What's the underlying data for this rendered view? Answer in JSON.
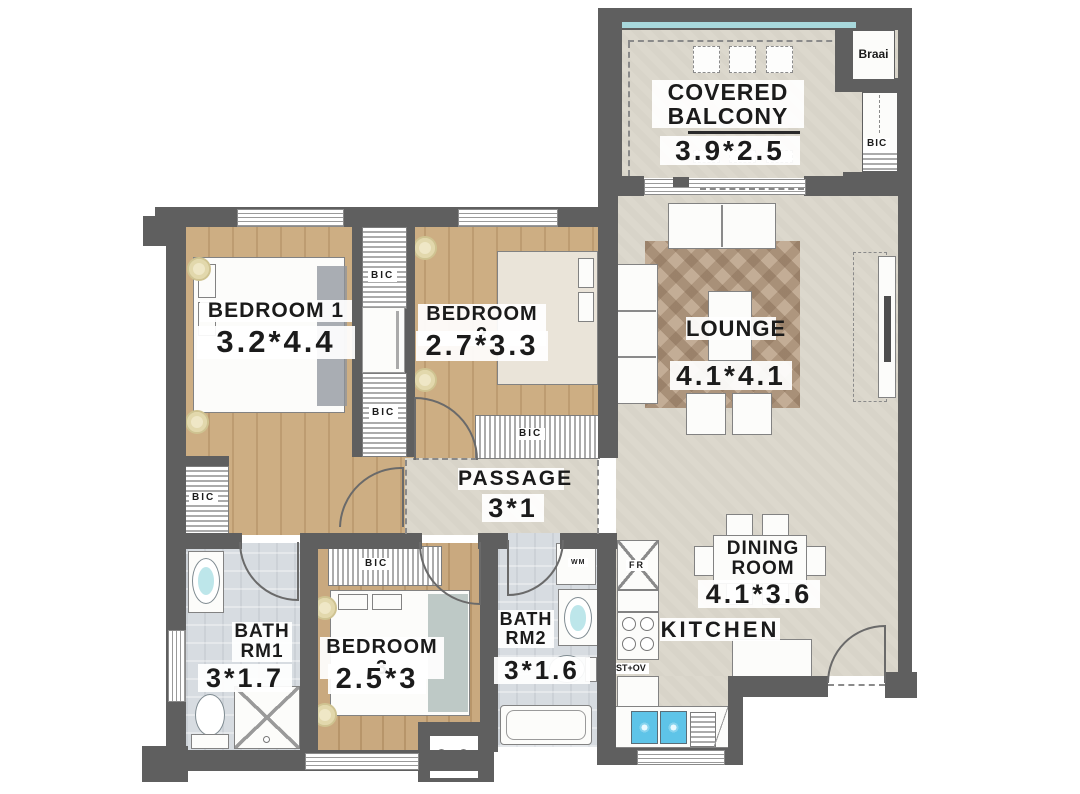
{
  "rooms": {
    "balcony": {
      "name_line1": "COVERED",
      "name_line2": "BALCONY",
      "dims": "3.9*2.5"
    },
    "lounge": {
      "name": "LOUNGE",
      "dims": "4.1*4.1"
    },
    "dining": {
      "name_line1": "DINING",
      "name_line2": "ROOM",
      "dims": "4.1*3.6"
    },
    "kitchen": {
      "name": "KITCHEN"
    },
    "passage": {
      "name": "PASSAGE",
      "dims": "3*1"
    },
    "bedroom1": {
      "name": "BEDROOM 1",
      "dims": "3.2*4.4"
    },
    "bedroom2": {
      "name": "BEDROOM 2",
      "dims": "2.7*3.3"
    },
    "bedroom3": {
      "name": "BEDROOM 3",
      "dims": "2.5*3"
    },
    "bath1": {
      "name_line1": "BATH",
      "name_line2": "RM1",
      "dims": "3*1.7"
    },
    "bath2": {
      "name_line1": "BATH",
      "name_line2": "RM2",
      "dims": "3*1.6"
    }
  },
  "fixtures": {
    "bic": "BIC",
    "braai": "Braai",
    "washing_machine": "WM",
    "fridge": "FR",
    "stove_oven": "ST+OV"
  },
  "colors": {
    "wall": "#5f5f5f",
    "wood_floor": "#c7a77d",
    "stone_floor": "#dcd8cd",
    "bath_floor": "#d7dce1",
    "glazing": "#a8d8dc",
    "sink": "#5ec4e8",
    "ceiling_light": "#efe7c6"
  }
}
